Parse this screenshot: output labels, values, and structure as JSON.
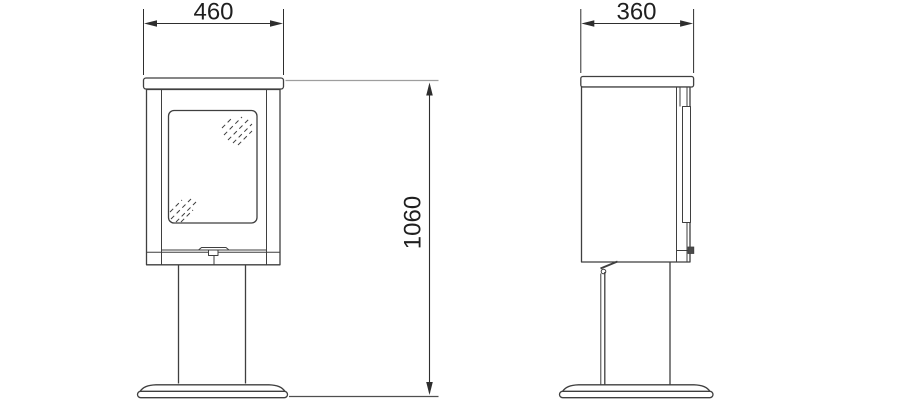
{
  "dimensions": {
    "front_width": {
      "label": "460"
    },
    "side_depth": {
      "label": "360"
    },
    "overall_height": {
      "label": "1060"
    }
  },
  "colors": {
    "background": "#ffffff",
    "object_line": "#3f3f3f",
    "dimension_line": "#2e2e2e",
    "extension_line": "#9e9e9e",
    "extension_line_dark": "#4f4f4f",
    "knob_fill": "#4a4a4a",
    "text": "#1f1f1f"
  }
}
